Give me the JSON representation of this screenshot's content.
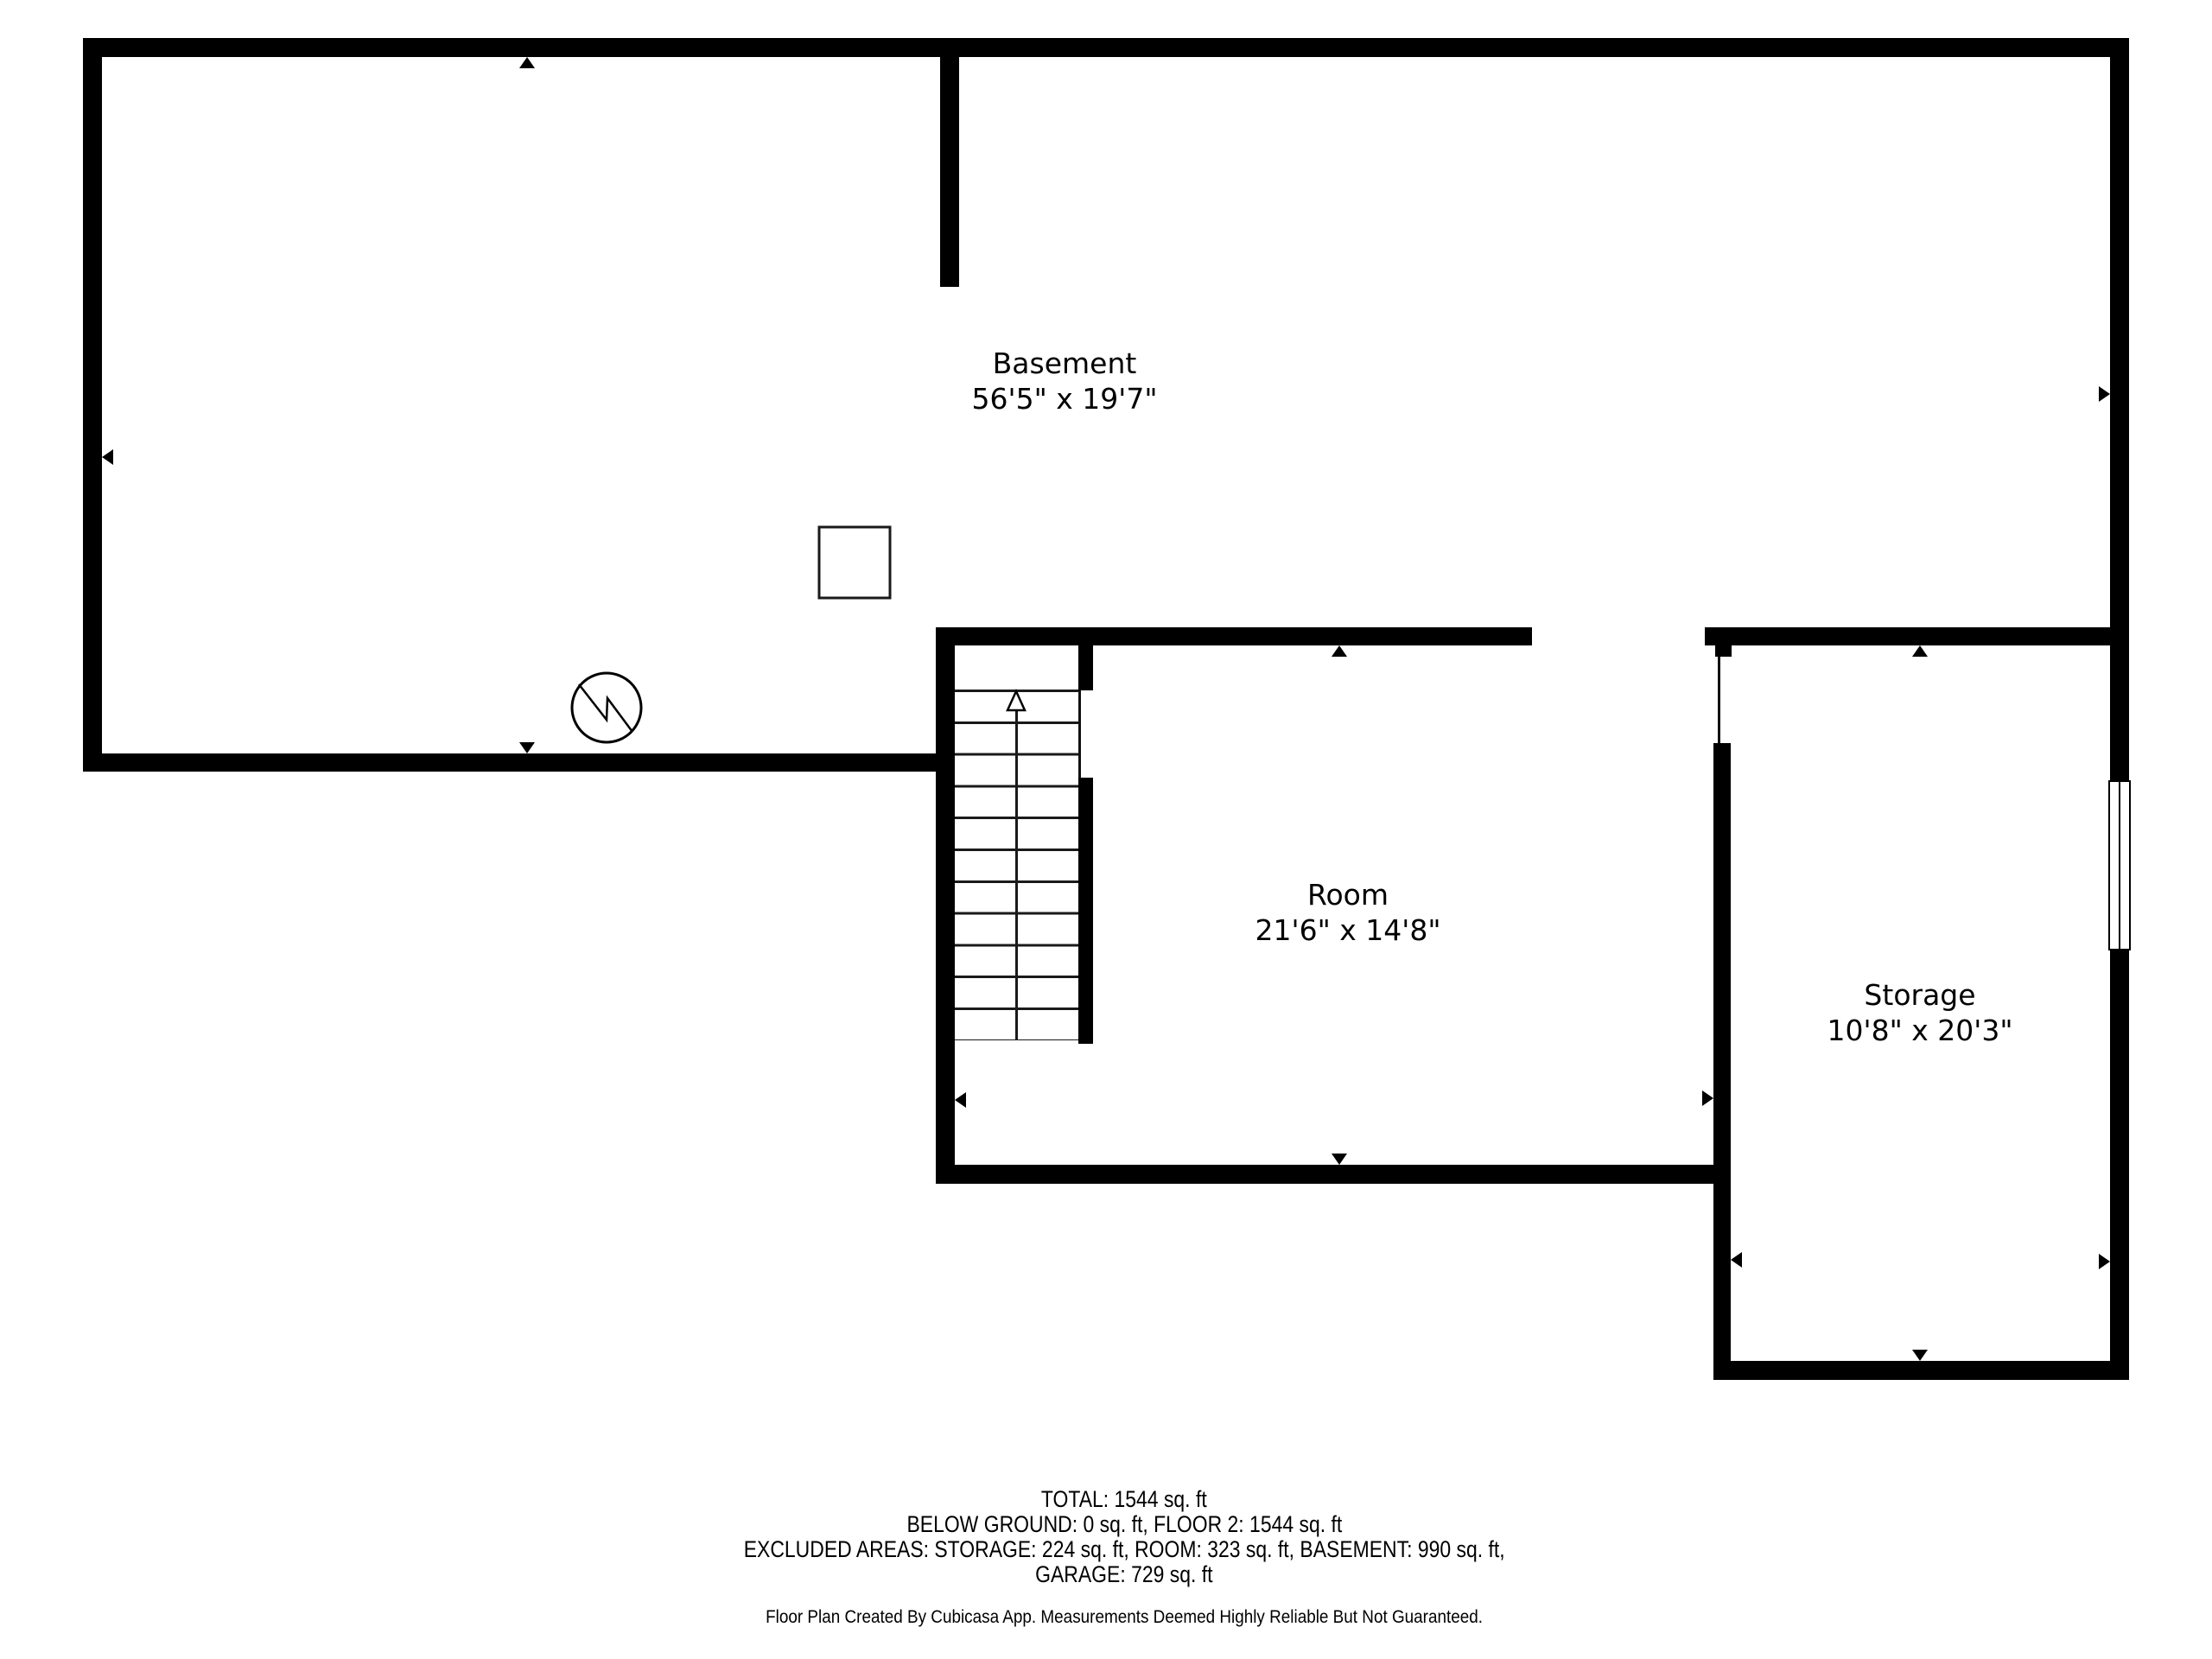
{
  "rooms": {
    "basement": {
      "name": "Basement",
      "dims": "56'5\" x 19'7\""
    },
    "room": {
      "name": "Room",
      "dims": "21'6\" x 14'8\""
    },
    "storage": {
      "name": "Storage",
      "dims": "10'8\" x 20'3\""
    }
  },
  "summary": {
    "line1": "TOTAL: 1544 sq. ft",
    "line2": "BELOW GROUND: 0 sq. ft, FLOOR 2: 1544 sq. ft",
    "line3": "EXCLUDED AREAS: STORAGE: 224 sq. ft, ROOM: 323 sq. ft, BASEMENT: 990 sq. ft,",
    "line4": "GARAGE: 729 sq. ft"
  },
  "attribution": "Floor Plan Created By Cubicasa App. Measurements Deemed Highly Reliable But Not Guaranteed.",
  "symbols": {
    "water_heater_icon": "circle with zigzag line",
    "fixture_square_icon": "empty square outline",
    "stairs_up_arrow_icon": "outlined upward arrow on stair run",
    "wall_marker_icon": "small filled triangle pointing at wall midpoint"
  },
  "colors": {
    "wall": "#000000",
    "background": "#ffffff",
    "text": "#000000"
  }
}
